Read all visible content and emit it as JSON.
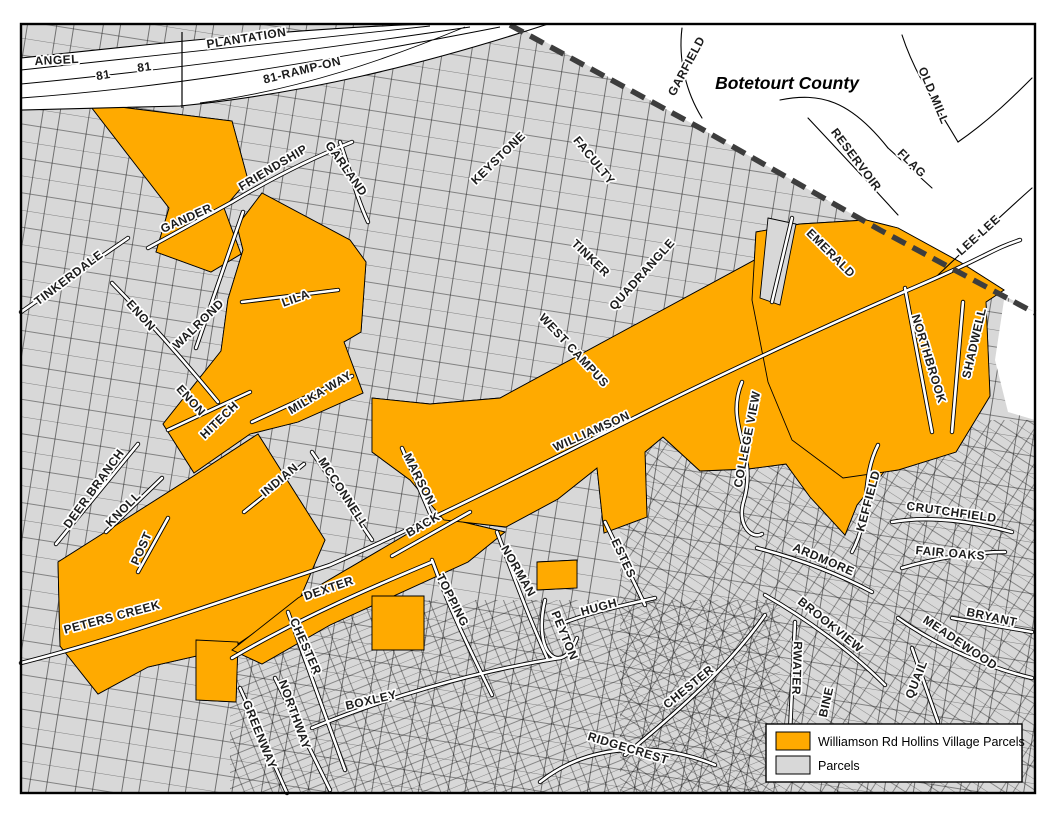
{
  "map": {
    "county_label": {
      "text": "Botetourt County",
      "x": 787,
      "y": 89
    },
    "colors": {
      "highlight_parcels": "#FFAA00",
      "parcels_gray": "#D8D8D8",
      "county_boundary": "#3D3D3D",
      "road_fill": "#FFFFFF",
      "line_black": "#000000"
    },
    "street_labels": [
      {
        "t": "ANGEL",
        "x": 57,
        "y": 64,
        "r": -3
      },
      {
        "t": "81",
        "x": 104,
        "y": 79,
        "r": -10
      },
      {
        "t": "81",
        "x": 145,
        "y": 71,
        "r": -8
      },
      {
        "t": "PLANTATION",
        "x": 247,
        "y": 42,
        "r": -9
      },
      {
        "t": "81-RAMP-ON",
        "x": 303,
        "y": 74,
        "r": -14
      },
      {
        "t": "GANDER",
        "x": 188,
        "y": 222,
        "r": -24
      },
      {
        "t": "FRIENDSHIP",
        "x": 275,
        "y": 171,
        "r": -31
      },
      {
        "t": "GARLAND",
        "x": 343,
        "y": 171,
        "r": 55
      },
      {
        "t": "TINKERDALE",
        "x": 71,
        "y": 281,
        "r": -37
      },
      {
        "t": "ENON",
        "x": 138,
        "y": 318,
        "r": 48
      },
      {
        "t": "WALROND",
        "x": 201,
        "y": 327,
        "r": -44
      },
      {
        "t": "ENON",
        "x": 188,
        "y": 403,
        "r": 48
      },
      {
        "t": "HITECH",
        "x": 222,
        "y": 423,
        "r": -44
      },
      {
        "t": "LILA",
        "x": 297,
        "y": 302,
        "r": -20
      },
      {
        "t": "MILKA WAY",
        "x": 322,
        "y": 396,
        "r": -31
      },
      {
        "t": "INDIAN",
        "x": 282,
        "y": 483,
        "r": -40
      },
      {
        "t": "MCCONNELL",
        "x": 340,
        "y": 495,
        "r": 57
      },
      {
        "t": "MARSON",
        "x": 416,
        "y": 481,
        "r": 63
      },
      {
        "t": "BACK",
        "x": 425,
        "y": 528,
        "r": -30
      },
      {
        "t": "DEXTER",
        "x": 330,
        "y": 592,
        "r": -19
      },
      {
        "t": "WILLIAMSON",
        "x": 593,
        "y": 435,
        "r": -24
      },
      {
        "t": "WEST CAMPUS",
        "x": 571,
        "y": 353,
        "r": 47
      },
      {
        "t": "TINKER",
        "x": 588,
        "y": 261,
        "r": 44
      },
      {
        "t": "QUADRANGLE",
        "x": 645,
        "y": 277,
        "r": -48
      },
      {
        "t": "KEYSTONE",
        "x": 501,
        "y": 161,
        "r": -44
      },
      {
        "t": "FACULTY",
        "x": 591,
        "y": 163,
        "r": 51
      },
      {
        "t": "GARFIELD",
        "x": 690,
        "y": 68,
        "r": -62
      },
      {
        "t": "OLD MILL",
        "x": 930,
        "y": 97,
        "r": 67
      },
      {
        "t": "RESERVOIR",
        "x": 853,
        "y": 162,
        "r": 53
      },
      {
        "t": "FLAG",
        "x": 909,
        "y": 166,
        "r": 45
      },
      {
        "t": "LEE LEE",
        "x": 981,
        "y": 238,
        "r": -42
      },
      {
        "t": "EMERALD",
        "x": 828,
        "y": 256,
        "r": 45
      },
      {
        "t": "NORTHBROOK",
        "x": 925,
        "y": 360,
        "r": 73
      },
      {
        "t": "SHADWELL",
        "x": 978,
        "y": 344,
        "r": -77
      },
      {
        "t": "COLLEGE VIEW",
        "x": 751,
        "y": 440,
        "r": -79
      },
      {
        "t": "KEFFIELD",
        "x": 872,
        "y": 502,
        "r": -75
      },
      {
        "t": "CRUTCHFIELD",
        "x": 951,
        "y": 516,
        "r": 8
      },
      {
        "t": "FAIR OAKS",
        "x": 950,
        "y": 557,
        "r": 5
      },
      {
        "t": "ARDMORE",
        "x": 822,
        "y": 563,
        "r": 23
      },
      {
        "t": "BROOKVIEW",
        "x": 828,
        "y": 628,
        "r": 39
      },
      {
        "t": "MEADEWOOD",
        "x": 958,
        "y": 646,
        "r": 34
      },
      {
        "t": "BRYANT",
        "x": 991,
        "y": 621,
        "r": 12
      },
      {
        "t": "QUAIL",
        "x": 920,
        "y": 681,
        "r": -68
      },
      {
        "t": "RWATER",
        "x": 793,
        "y": 668,
        "r": 92
      },
      {
        "t": "BINE",
        "x": 830,
        "y": 703,
        "r": -77
      },
      {
        "t": "PETERS CREEK",
        "x": 113,
        "y": 621,
        "r": -15
      },
      {
        "t": "DEER BRANCH",
        "x": 97,
        "y": 491,
        "r": -54
      },
      {
        "t": "KNOLL",
        "x": 126,
        "y": 512,
        "r": -45
      },
      {
        "t": "POST",
        "x": 145,
        "y": 550,
        "r": -66
      },
      {
        "t": "GREENWAY",
        "x": 256,
        "y": 736,
        "r": 68
      },
      {
        "t": "NORTHWAY",
        "x": 291,
        "y": 716,
        "r": 70
      },
      {
        "t": "CHESTER",
        "x": 302,
        "y": 648,
        "r": 66
      },
      {
        "t": "BOXLEY",
        "x": 372,
        "y": 704,
        "r": -13
      },
      {
        "t": "TOPPING",
        "x": 449,
        "y": 602,
        "r": 63
      },
      {
        "t": "NORMAN",
        "x": 515,
        "y": 573,
        "r": 60
      },
      {
        "t": "ESTES",
        "x": 620,
        "y": 560,
        "r": 65
      },
      {
        "t": "PEYTON",
        "x": 561,
        "y": 637,
        "r": 68
      },
      {
        "t": "HUGH",
        "x": 600,
        "y": 611,
        "r": -15
      },
      {
        "t": "CHESTER",
        "x": 691,
        "y": 690,
        "r": -39
      },
      {
        "t": "RIDGECREST",
        "x": 627,
        "y": 752,
        "r": 17
      }
    ]
  },
  "legend": {
    "items": [
      {
        "label": "Williamson Rd Hollins Village Parcels",
        "color": "#FFAA00"
      },
      {
        "label": "Parcels",
        "color": "#D8D8D8"
      }
    ]
  }
}
